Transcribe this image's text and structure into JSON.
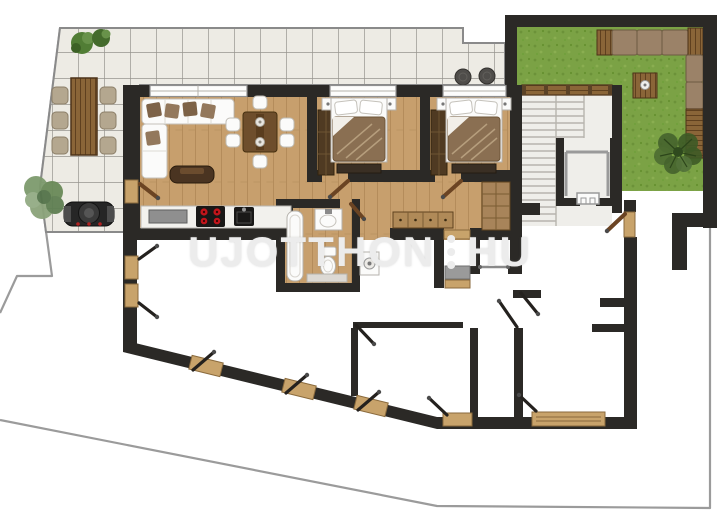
{
  "watermark": {
    "left": "UJOTTHON",
    "right": "HU"
  },
  "palette": {
    "boundary": "#9b9b9b",
    "wall": "#2b2926",
    "tile": "#edebe4",
    "tile_line": "#97958e",
    "wood_floor": "#c79f6d",
    "grass": "#7ba245",
    "grass_dark": "#6c9239",
    "dark_wood": "#4f3a22",
    "mid_wood": "#8a6538",
    "light_wood": "#c8a36b",
    "white_furniture": "#fbfbfa",
    "cushion": "#9b8268",
    "blanket": "#8a6f52",
    "burner_red": "#c2151b",
    "fixture_gray": "#9a9a9a",
    "step_line": "#b7b4ae",
    "watermark_color": "#ececec"
  },
  "depicted_areas": [
    "tiled-terrace",
    "outdoor-dining-set",
    "bbq-grill",
    "terrace-plants",
    "living-room",
    "corner-sofa",
    "tv-console",
    "dining-set",
    "kitchen-counter",
    "bedroom-1",
    "bedroom-2",
    "bathroom",
    "entry-hall",
    "corridor",
    "staircase",
    "elevator",
    "garden-lawn",
    "outdoor-lounge-sofa",
    "lower-level-rooms",
    "property-boundary"
  ]
}
